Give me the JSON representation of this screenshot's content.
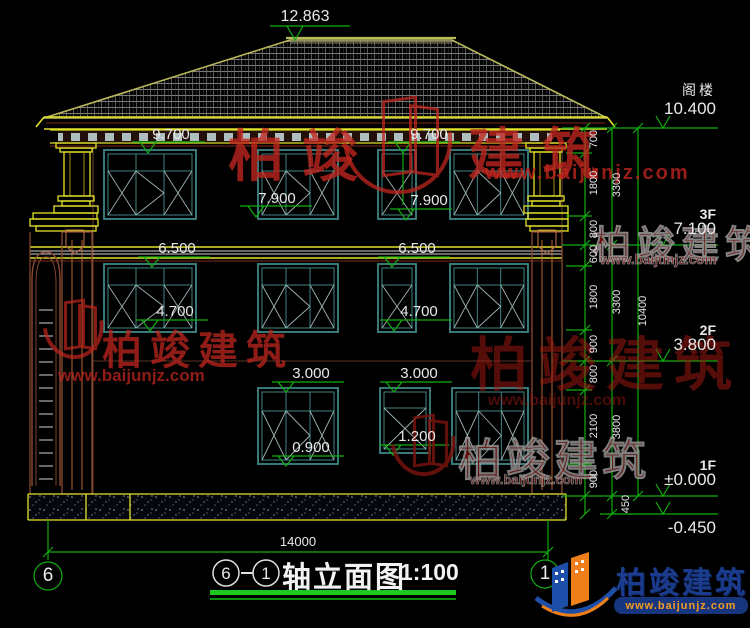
{
  "drawing": {
    "ridge_elevation": "12.863",
    "facade_markers": [
      "9.700",
      "9.700",
      "7.900",
      "7.900",
      "6.500",
      "6.500",
      "4.700",
      "4.700",
      "3.000",
      "3.000",
      "1.200",
      "0.900"
    ],
    "levels": [
      {
        "label": "阁楼",
        "value": "10.400"
      },
      {
        "label": "3F",
        "value": "7.100"
      },
      {
        "label": "2F",
        "value": "3.800"
      },
      {
        "label": "1F",
        "value": "±0.000"
      }
    ],
    "ground_level": "-0.450",
    "dim_chain_inner": [
      "700",
      "1800",
      "800",
      "600",
      "1800",
      "900",
      "800",
      "2100",
      "900"
    ],
    "dim_chain_mid": [
      "3300",
      "3300",
      "3800"
    ],
    "dim_chain_total": "10400",
    "dim_below_ground": "450",
    "overall_width": "14000",
    "axis_left": "6",
    "axis_right": "1"
  },
  "title": {
    "axis_from": "6",
    "axis_to": "1",
    "name": "轴立面图",
    "scale": "1:100"
  },
  "watermark": {
    "brand_left": "柏竣",
    "brand_right": "建筑",
    "brand": "柏竣建筑",
    "url": "www.baijunjz.com"
  },
  "logo": {
    "brand": "柏竣建筑",
    "url": "www.baijunjz.com"
  }
}
